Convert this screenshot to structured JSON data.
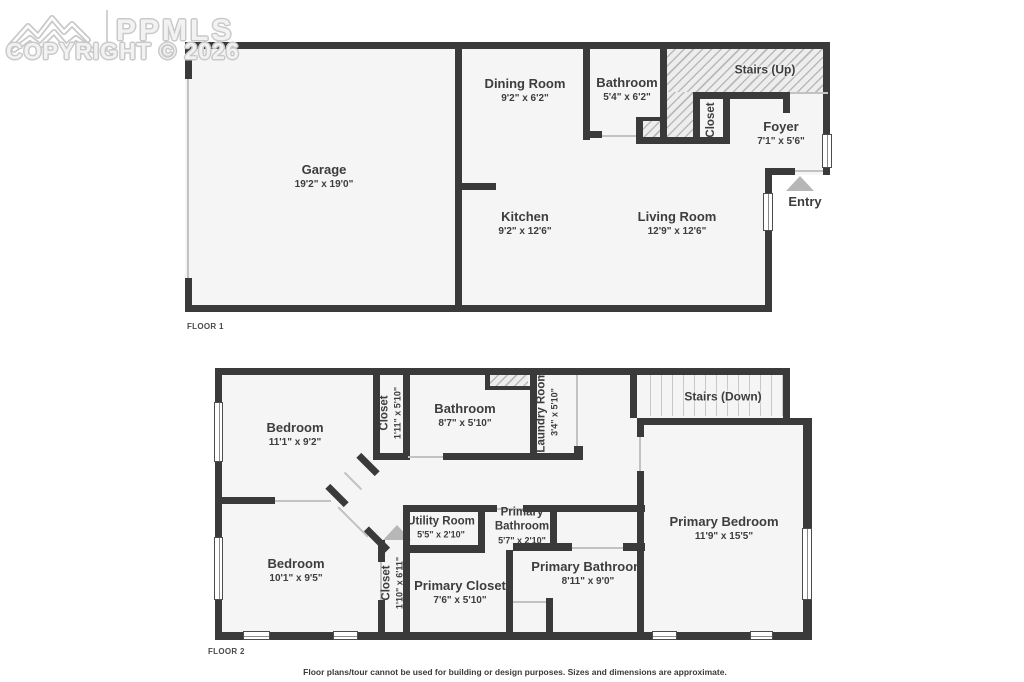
{
  "watermark": {
    "brand": "PPMLS",
    "copyright": "COPYRIGHT © 2026"
  },
  "floor1": {
    "tag": "FLOOR 1",
    "garage": {
      "name": "Garage",
      "dims": "19'2\" x 19'0\""
    },
    "dining": {
      "name": "Dining Room",
      "dims": "9'2\" x 6'2\""
    },
    "bathroom": {
      "name": "Bathroom",
      "dims": "5'4\" x 6'2\""
    },
    "stairs": {
      "name": "Stairs (Up)"
    },
    "closet": {
      "name": "Closet"
    },
    "foyer": {
      "name": "Foyer",
      "dims": "7'1\" x 5'6\""
    },
    "kitchen": {
      "name": "Kitchen",
      "dims": "9'2\" x 12'6\""
    },
    "living": {
      "name": "Living Room",
      "dims": "12'9\" x 12'6\""
    },
    "entry": {
      "name": "Entry"
    }
  },
  "floor2": {
    "tag": "FLOOR 2",
    "bedroom_upper": {
      "name": "Bedroom",
      "dims": "11'1\" x 9'2\""
    },
    "closet_upper": {
      "name": "Closet",
      "dims": "1'11\" x 5'10\""
    },
    "bathroom": {
      "name": "Bathroom",
      "dims": "8'7\" x 5'10\""
    },
    "laundry": {
      "name": "Laundry Room",
      "dims": "3'4\" x 5'10\""
    },
    "stairs": {
      "name": "Stairs (Down)"
    },
    "primary_bedroom": {
      "name": "Primary Bedroom",
      "dims": "11'9\" x 15'5\""
    },
    "utility": {
      "name": "Utility Room",
      "dims": "5'5\" x 2'10\""
    },
    "primary_bathroom_small": {
      "name": "Primary Bathroom",
      "dims": "5'7\" x 2'10\""
    },
    "primary_bathroom": {
      "name": "Primary Bathroom",
      "dims": "8'11\" x 9'0\""
    },
    "primary_closet": {
      "name": "Primary Closet",
      "dims": "7'6\" x 5'10\""
    },
    "bedroom_lower": {
      "name": "Bedroom",
      "dims": "10'1\" x 9'5\""
    },
    "closet_lower": {
      "name": "Closet",
      "dims": "1'10\" x 6'11\""
    }
  },
  "disclaimer": "Floor plans/tour cannot be used for building or design purposes. Sizes and dimensions are approximate.",
  "colors": {
    "wall": "#3a3a3a",
    "room_fill": "#f5f5f5",
    "text": "#3d3d3d",
    "entry_arrow": "#b7b7b7"
  }
}
